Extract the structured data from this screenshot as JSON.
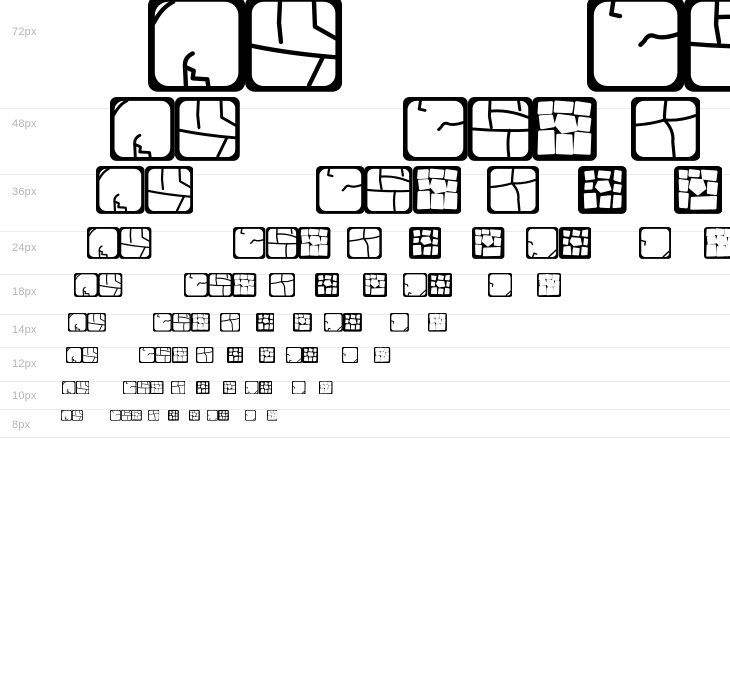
{
  "page": {
    "background": "#ffffff",
    "title": "Font size waterfall preview"
  },
  "waterfall": {
    "label_color": "#b5b5b5",
    "divider_color": "#ebebeb",
    "glyph_color": "#000000",
    "glyph_advance_em": 1.35,
    "glyph_height_em": 1.33,
    "viewport_width": 730,
    "sequence": [
      {
        "glyph": "tile-branch-crack",
        "offset_em": 0
      },
      {
        "glyph": "tile-five-shards",
        "offset_em": 1.35
      },
      {
        "glyph": "tile-hook-crack",
        "offset_em": 6.1
      },
      {
        "glyph": "tile-grid-shards",
        "offset_em": 7.45
      },
      {
        "glyph": "pebbles-cluster",
        "offset_em": 8.8
      },
      {
        "glyph": "tile-quad-shards",
        "offset_em": 10.85,
        "width_em": 1.45
      },
      {
        "glyph": "pebbles-dark",
        "offset_em": 13.4
      },
      {
        "glyph": "pebbles-ring",
        "offset_em": 16.05
      },
      {
        "glyph": "tile-edge-cracks",
        "offset_em": 18.3
      },
      {
        "glyph": "pebbles-dark-2",
        "offset_em": 19.65
      },
      {
        "glyph": "tile-sparse-cracks",
        "offset_em": 23.0
      },
      {
        "glyph": "pebbles-light",
        "offset_em": 25.7
      }
    ],
    "rows": [
      {
        "label": "72px",
        "size": 72,
        "text_x": 148,
        "glyph_top": -4,
        "divider_y": 108,
        "label_y": 26
      },
      {
        "label": "48px",
        "size": 48,
        "text_x": 110,
        "glyph_top": 97,
        "divider_y": 174,
        "label_y": 118
      },
      {
        "label": "36px",
        "size": 36,
        "text_x": 96,
        "glyph_top": 166,
        "divider_y": 231,
        "label_y": 186
      },
      {
        "label": "24px",
        "size": 24,
        "text_x": 87,
        "glyph_top": 227,
        "divider_y": 274,
        "label_y": 242
      },
      {
        "label": "18px",
        "size": 18,
        "text_x": 74,
        "glyph_top": 273,
        "divider_y": 314,
        "label_y": 286
      },
      {
        "label": "14px",
        "size": 14,
        "text_x": 68,
        "glyph_top": 313,
        "divider_y": 347,
        "label_y": 324
      },
      {
        "label": "12px",
        "size": 12,
        "text_x": 66,
        "glyph_top": 347,
        "divider_y": 381,
        "label_y": 358
      },
      {
        "label": "10px",
        "size": 10,
        "text_x": 62,
        "glyph_top": 381,
        "divider_y": 409,
        "label_y": 390
      },
      {
        "label": "8px",
        "size": 8,
        "text_x": 61,
        "glyph_top": 410,
        "divider_y": 437,
        "label_y": 419
      }
    ]
  }
}
